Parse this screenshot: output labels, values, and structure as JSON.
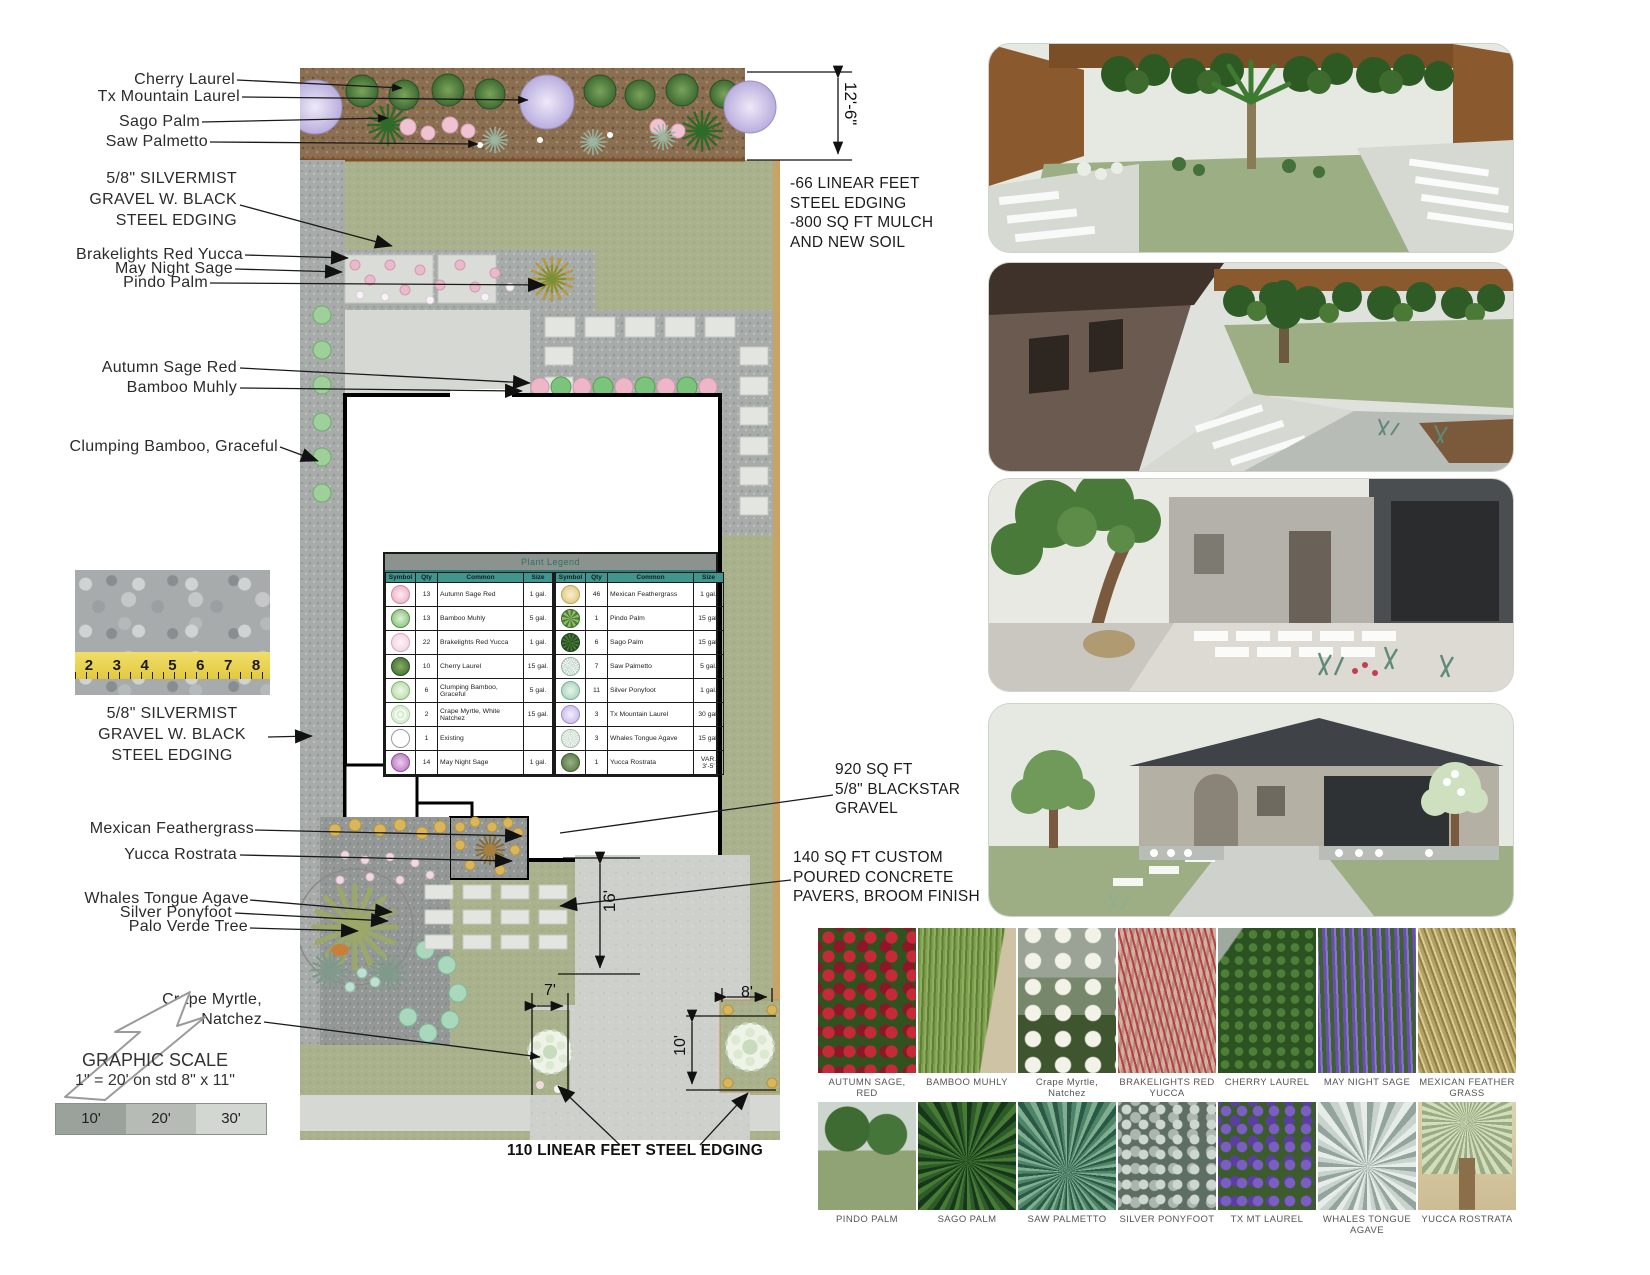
{
  "callouts": {
    "cherry_laurel": "Cherry Laurel",
    "tx_mountain_laurel": "Tx Mountain Laurel",
    "sago_palm": "Sago Palm",
    "saw_palmetto": "Saw Palmetto",
    "silvermist_top": "5/8\" SILVERMIST\nGRAVEL W. BLACK\nSTEEL EDGING",
    "brakelights_red_yucca": "Brakelights Red Yucca",
    "may_night_sage": "May Night Sage",
    "pindo_palm": "Pindo Palm",
    "autumn_sage_red": "Autumn Sage Red",
    "bamboo_muhly": "Bamboo Muhly",
    "clumping_bamboo": "Clumping Bamboo, Graceful",
    "silvermist_bottom": "5/8\" SILVERMIST\nGRAVEL W. BLACK\nSTEEL EDGING",
    "mexican_feathergrass": "Mexican Feathergrass",
    "yucca_rostrata": "Yucca Rostrata",
    "whales_tongue_agave": "Whales Tongue Agave",
    "silver_ponyfoot": "Silver Ponyfoot",
    "palo_verde_tree": "Palo Verde Tree",
    "crape_myrtle": "Crape Myrtle,\nNatchez"
  },
  "annotations": {
    "edging_mulch": "-66 LINEAR FEET\nSTEEL EDGING\n-800 SQ FT MULCH\nAND NEW SOIL",
    "blackstar": "920 SQ FT\n5/8\" BLACKSTAR\nGRAVEL",
    "pavers": "140 SQ FT CUSTOM\nPOURED CONCRETE\nPAVERS, BROOM FINISH",
    "bottom_edging": "110 LINEAR FEET STEEL EDGING"
  },
  "dimensions": {
    "height_top": "12'-6\"",
    "height_mid": "16'",
    "w7": "7'",
    "w8": "8'",
    "h10": "10'"
  },
  "legend": {
    "title": "Plant Legend",
    "headers": [
      "Symbol",
      "Qty",
      "Common",
      "Size"
    ],
    "rows_left": [
      {
        "qty": "13",
        "common": "Autumn Sage Red",
        "size": "1 gal.",
        "symbol": "autumn-sage"
      },
      {
        "qty": "13",
        "common": "Bamboo Muhly",
        "size": "5 gal.",
        "symbol": "bamboo-muhly"
      },
      {
        "qty": "22",
        "common": "Brakelights Red Yucca",
        "size": "1 gal.",
        "symbol": "brakelights"
      },
      {
        "qty": "10",
        "common": "Cherry Laurel",
        "size": "15 gal.",
        "symbol": "cherry-laurel"
      },
      {
        "qty": "6",
        "common": "Clumping Bamboo, Graceful",
        "size": "5 gal.",
        "symbol": "clumping-bamboo"
      },
      {
        "qty": "2",
        "common": "Crape Myrtle, White Natchez",
        "size": "15 gal.",
        "symbol": "crape-myrtle"
      },
      {
        "qty": "1",
        "common": "Existing",
        "size": "",
        "symbol": "existing"
      },
      {
        "qty": "14",
        "common": "May Night Sage",
        "size": "1 gal.",
        "symbol": "may-night"
      }
    ],
    "rows_right": [
      {
        "qty": "46",
        "common": "Mexican Feathergrass",
        "size": "1 gal.",
        "symbol": "feathergrass"
      },
      {
        "qty": "1",
        "common": "Pindo Palm",
        "size": "15 gal.",
        "symbol": "pindo"
      },
      {
        "qty": "6",
        "common": "Sago Palm",
        "size": "15 gal.",
        "symbol": "sago"
      },
      {
        "qty": "7",
        "common": "Saw Palmetto",
        "size": "5 gal.",
        "symbol": "saw-palmetto"
      },
      {
        "qty": "11",
        "common": "Silver Ponyfoot",
        "size": "1 gal.",
        "symbol": "silver-ponyfoot"
      },
      {
        "qty": "3",
        "common": "Tx Mountain Laurel",
        "size": "30 gal.",
        "symbol": "tx-laurel"
      },
      {
        "qty": "3",
        "common": "Whales Tongue Agave",
        "size": "15 gal.",
        "symbol": "whales-tongue"
      },
      {
        "qty": "1",
        "common": "Yucca Rostrata",
        "size": "VAR. 3'-5'",
        "symbol": "yucca"
      }
    ]
  },
  "scale": {
    "title": "GRAPHIC SCALE",
    "subtitle": "1\" = 20' on std 8\" x 11\"",
    "segments": [
      "10'",
      "20'",
      "30'"
    ]
  },
  "gravel_photo": {
    "ruler_numbers": [
      "2",
      "3",
      "4",
      "5",
      "6",
      "7",
      "8"
    ]
  },
  "thumbnails": {
    "row1": [
      {
        "label": "AUTUMN SAGE, RED",
        "kind": "autumn-sage"
      },
      {
        "label": "BAMBOO MUHLY",
        "kind": "bamboo-muhly"
      },
      {
        "label": "Crape Myrtle,\nNatchez",
        "kind": "crape-myrtle"
      },
      {
        "label": "BRAKELIGHTS RED\nYUCCA",
        "kind": "brakelights"
      },
      {
        "label": "CHERRY LAUREL",
        "kind": "cherry-laurel"
      },
      {
        "label": "MAY NIGHT SAGE",
        "kind": "may-night"
      },
      {
        "label": "MEXICAN FEATHER\nGRASS",
        "kind": "feathergrass"
      }
    ],
    "row2": [
      {
        "label": "PINDO PALM",
        "kind": "pindo"
      },
      {
        "label": "SAGO PALM",
        "kind": "sago"
      },
      {
        "label": "SAW PALMETTO",
        "kind": "saw-palmetto"
      },
      {
        "label": "SILVER PONYFOOT",
        "kind": "silver-ponyfoot"
      },
      {
        "label": "TX MT LAUREL",
        "kind": "tx-laurel"
      },
      {
        "label": "WHALES TONGUE\nAGAVE",
        "kind": "whales-tongue"
      },
      {
        "label": "YUCCA ROSTRATA",
        "kind": "yucca"
      }
    ]
  },
  "colors": {
    "legend_header_teal": "#41958d",
    "lawn_green": "#a9b28c",
    "mulch_brown": "#8b6f53",
    "gravel_gray": "#a7abaa",
    "concrete_gray": "#ced1cb"
  }
}
